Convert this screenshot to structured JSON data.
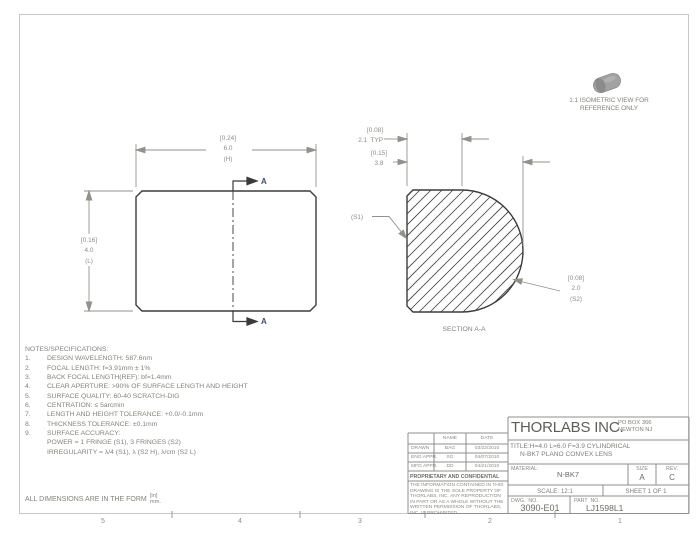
{
  "page": {
    "iso_note_line1": "1:1 ISOMETRIC VIEW FOR",
    "iso_note_line2": "REFERENCE ONLY"
  },
  "front_view": {
    "dim_width": {
      "bracket": "[0.24]",
      "value": "6.0",
      "suffix": "(H)"
    },
    "dim_height": {
      "bracket": "[0.16]",
      "value": "4.0",
      "suffix": "(L)"
    },
    "section_arrow_label": "A"
  },
  "section_view": {
    "title": "SECTION A-A",
    "dim_edge": {
      "bracket": "[0.08]",
      "value": "2.1  TYP"
    },
    "dim_thickness": {
      "bracket": "[0.15]",
      "value": "3.8"
    },
    "surface1_label": "(S1)",
    "dim_radius": {
      "bracket": "[0.08]",
      "value": "2.0",
      "suffix": "(S2)"
    }
  },
  "notes": {
    "heading": "NOTES/SPECIFICATIONS:",
    "items": [
      {
        "num": "1.",
        "text": "DESIGN WAVELENGTH: 587.6nm"
      },
      {
        "num": "2.",
        "text": "FOCAL LENGTH: f=3.91mm ± 1%"
      },
      {
        "num": "3.",
        "text": "BACK FOCAL LENGTH(REF): bf=1.4mm"
      },
      {
        "num": "4.",
        "text": "CLEAR APERTURE: >90% OF SURFACE LENGTH AND HEIGHT"
      },
      {
        "num": "5.",
        "text": "SURFACE QUALITY: 60-40 SCRATCH-DIG"
      },
      {
        "num": "6.",
        "text": "CENTRATION: ≤ 5arcmin"
      },
      {
        "num": "7.",
        "text": "LENGTH AND HEIGHT TOLERANCE: +0.0/-0.1mm"
      },
      {
        "num": "8.",
        "text": "THICKNESS TOLERANCE: ±0.1mm"
      },
      {
        "num": "9.",
        "text": "SURFACE ACCURACY:"
      },
      {
        "num": "",
        "text": "POWER = 1 FRINGE (S1), 3 FRINGES (S2)"
      },
      {
        "num": "",
        "text": "IRREGULARITY = λ/4 (S1), λ (S2 H), λ/cm (S2 L)"
      }
    ]
  },
  "footer": {
    "prefix": "ALL DIMENSIONS ARE IN THE FORM",
    "upper": "[in]",
    "lower": "mm.",
    "ruler": [
      "5",
      "4",
      "3",
      "2",
      "1"
    ]
  },
  "title_block": {
    "company": "THORLABS INC.",
    "address_line1": "PO BOX 366",
    "address_line2": "NEWTON NJ",
    "title_line1": "TITLE:H=4.0 L=6.0 F=3.9 CYLINDRICAL",
    "title_line2": "N-BK7 PLANO CONVEX LENS",
    "material_label": "MATERIAL:",
    "material_value": "N-BK7",
    "size_label": "SIZE",
    "size_value": "A",
    "rev_label": "REV.",
    "rev_value": "C",
    "scale": "SCALE: 12:1",
    "sheet": "SHEET 1 OF 1",
    "dwg_label": "DWG.  NO.",
    "dwg_value": "3090-E01",
    "part_label": "PART  NO.",
    "part_value": "LJ1598L1",
    "approvals": {
      "name_header": "NAME",
      "date_header": "DATE",
      "rows": [
        {
          "role": "DRAWN",
          "name": "BAG",
          "date": "03/22/2010"
        },
        {
          "role": "ENG APPR.",
          "name": "SG",
          "date": "04/07/2010"
        },
        {
          "role": "MFG APPR.",
          "name": "DD",
          "date": "04/21/2010"
        }
      ]
    },
    "proprietary_heading": "PROPRIETARY AND CONFIDENTIAL",
    "proprietary_text": "THE INFORMATION CONTAINED IN THIS DRAWING IS THE SOLE PROPERTY OF THORLABS, INC.  ANY REPRODUCTION IN PART OR AS A WHOLE WITHOUT THE WRITTEN PERMISSION OF THORLABS, INC. IS PROHIBITED."
  },
  "colors": {
    "outline": "#3c3c3c",
    "dimension": "#92928a",
    "frame": "#c7c7c7",
    "grid": "#8f8f8f",
    "section_label": "#3f4e6e"
  }
}
